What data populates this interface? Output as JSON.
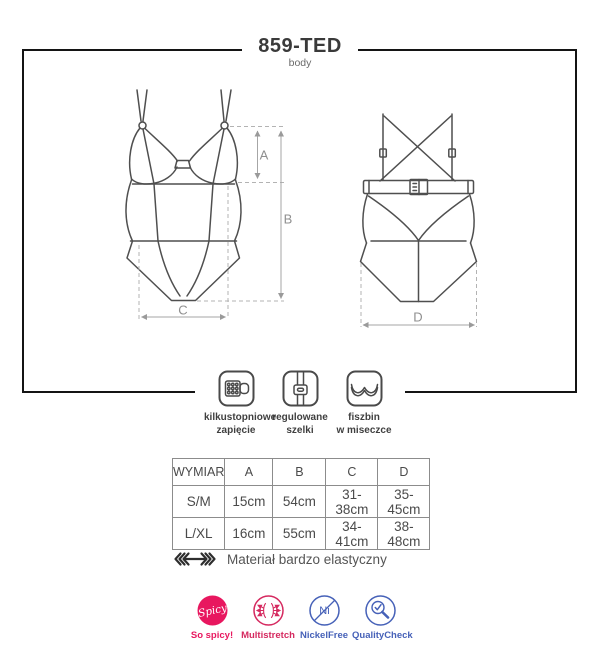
{
  "page": {
    "title": "859-TED",
    "subtitle": "body"
  },
  "diagram": {
    "dim_labels": {
      "a": "A",
      "b": "B",
      "c": "C",
      "d": "D"
    }
  },
  "features": [
    {
      "name": "multi-hook-closure",
      "line1": "kilkustopniowe",
      "line2": "zapięcie"
    },
    {
      "name": "adjustable-straps",
      "line1": "regulowane",
      "line2": "szelki"
    },
    {
      "name": "underwire-cup",
      "line1": "fiszbin",
      "line2": "w miseczce"
    }
  ],
  "size_table": {
    "headers": [
      "WYMIAR",
      "A",
      "B",
      "C",
      "D"
    ],
    "rows": [
      {
        "size": "S/M",
        "a": "15cm",
        "b": "54cm",
        "c": "31-38cm",
        "d": "35-45cm"
      },
      {
        "size": "L/XL",
        "a": "16cm",
        "b": "55cm",
        "c": "34-41cm",
        "d": "38-48cm"
      }
    ]
  },
  "material_note": "Materiał bardzo elastyczny",
  "badges": [
    {
      "label": "So spicy!",
      "icon_text": "Spicy",
      "color": "#e8175f"
    },
    {
      "label": "Multistretch",
      "color": "#d5295f"
    },
    {
      "label": "NickelFree",
      "icon_text": "Ni",
      "color": "#4661b8"
    },
    {
      "label": "QualityCheck",
      "color": "#4661b8"
    }
  ]
}
